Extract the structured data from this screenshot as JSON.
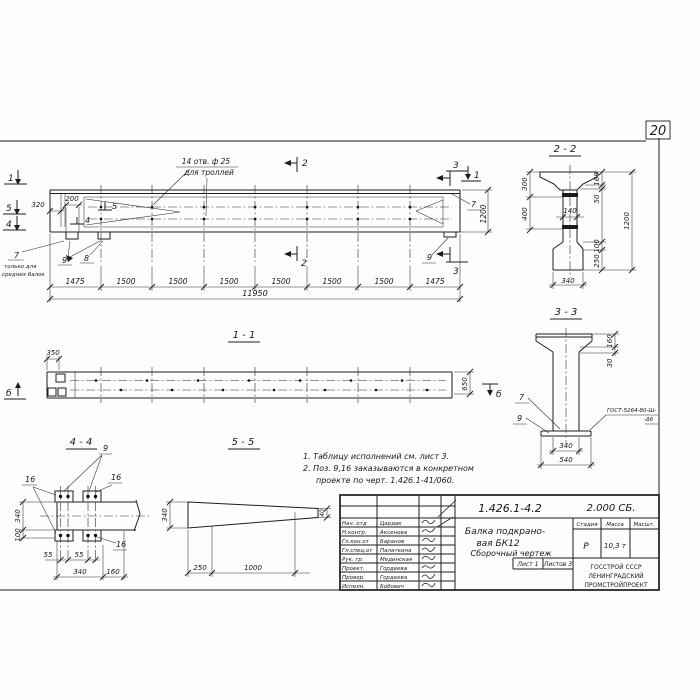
{
  "page_number": "20",
  "elevation": {
    "hole_note1": "14 отв. ф 25",
    "hole_note2": "для троллей",
    "d320": "320",
    "d200": "200",
    "d1200": "1200",
    "flag5": "5",
    "flag4": "4",
    "mark1": "1",
    "mark5": "5",
    "mark4": "4",
    "mark2": "2",
    "mark3": "3",
    "pos7": "7",
    "pos8": "8",
    "pos9": "9",
    "note7a": "только для",
    "note7b": "средних балок",
    "segs": [
      "1475",
      "1500",
      "1500",
      "1500",
      "1500",
      "1500",
      "1500",
      "1475"
    ],
    "total": "11950"
  },
  "sec22": {
    "title": "2 - 2",
    "d300": "300",
    "d400": "400",
    "d140": "140",
    "d160": "160",
    "d50": "50",
    "d1200": "1200",
    "d100": "100",
    "d250": "250",
    "d340": "340"
  },
  "sec33": {
    "title": "3 - 3",
    "d160": "160",
    "d30": "30",
    "d340": "340",
    "d540": "540",
    "pos7": "7",
    "pos9": "9",
    "weld1": "ГОСТ-5264-80-Ш-",
    "weld2": "-Δ6"
  },
  "sec11": {
    "title": "1 - 1",
    "d350": "350",
    "d650": "650",
    "markb": "б"
  },
  "sec44": {
    "title": "4 - 4",
    "pos9": "9",
    "pos16": "16",
    "dv340": "340",
    "dv100": "100",
    "d55": "55",
    "db340": "340",
    "db160": "160"
  },
  "sec55": {
    "title": "5 - 5",
    "d340": "340",
    "d40": "40",
    "d250": "250",
    "d1000": "1000"
  },
  "notes": {
    "n1": "1. Таблицу исполнений см. лист 3.",
    "n2": "2. Поз. 9,16 заказываются в конкретном",
    "n3": "проекте по черт. 1.426.1-41/060."
  },
  "title_block": {
    "doc_number": "1.426.1-4.2",
    "series": "2.000 СБ.",
    "name1": "Балка подкрано-",
    "name2": "вая  БК12",
    "name3": "Сборочный чертеж",
    "stage_h": "Стадия",
    "mass_h": "Масса",
    "scale_h": "Масшт.",
    "stage": "Р",
    "mass": "10,3 т",
    "sheet": "Лист 1",
    "sheets": "Листов 3",
    "org1": "ГОССТРОЙ СССР",
    "org2": "ЛЕНИНГРАДСКИЙ",
    "org3": "ПРОМСТРОЙПРОЕКТ",
    "rows": [
      {
        "role": "Нач. отд",
        "name": "Цардак"
      },
      {
        "role": "Н.контр.",
        "name": "Аксенова"
      },
      {
        "role": "Гл.кон.от",
        "name": "Баранов"
      },
      {
        "role": "Гл.спец.от",
        "name": "Палаткина"
      },
      {
        "role": "Рук. гр.",
        "name": "Мединская"
      },
      {
        "role": "Проект.",
        "name": "Гордеева"
      },
      {
        "role": "Провер.",
        "name": "Гордеева"
      },
      {
        "role": "Исполн.",
        "name": "Бобович"
      }
    ]
  }
}
